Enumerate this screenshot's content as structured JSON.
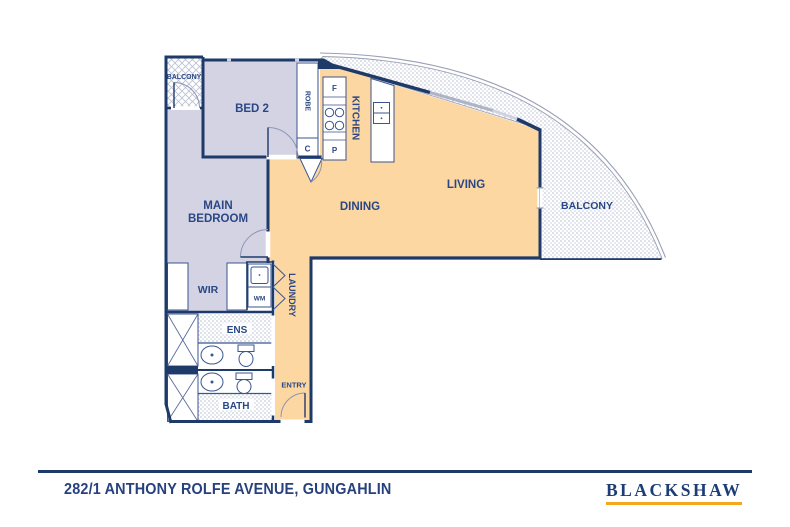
{
  "footer": {
    "address": "282/1 ANTHONY ROLFE AVENUE, GUNGAHLIN",
    "brand": "BLACKSHAW"
  },
  "plan": {
    "rooms": {
      "balcony_left": "BALCONY",
      "bed2": "BED 2",
      "robe": "ROBE",
      "kitchen": "KITCHEN",
      "main_bedroom_l1": "MAIN",
      "main_bedroom_l2": "BEDROOM",
      "dining": "DINING",
      "living": "LIVING",
      "balcony_right": "BALCONY",
      "wir": "WIR",
      "laundry": "LAUNDRY",
      "ens": "ENS",
      "bath": "BATH",
      "entry": "ENTRY"
    },
    "fixtures": {
      "fridge": "F",
      "cupboard": "C",
      "pantry": "P",
      "washing_machine": "WM"
    }
  },
  "colors": {
    "wall_navy": "#1e3a69",
    "label_blue": "#2a4785",
    "bedroom_lavender": "#d4d3e4",
    "living_orange": "#fdd7a2",
    "logo_gold": "#f3a81d"
  }
}
